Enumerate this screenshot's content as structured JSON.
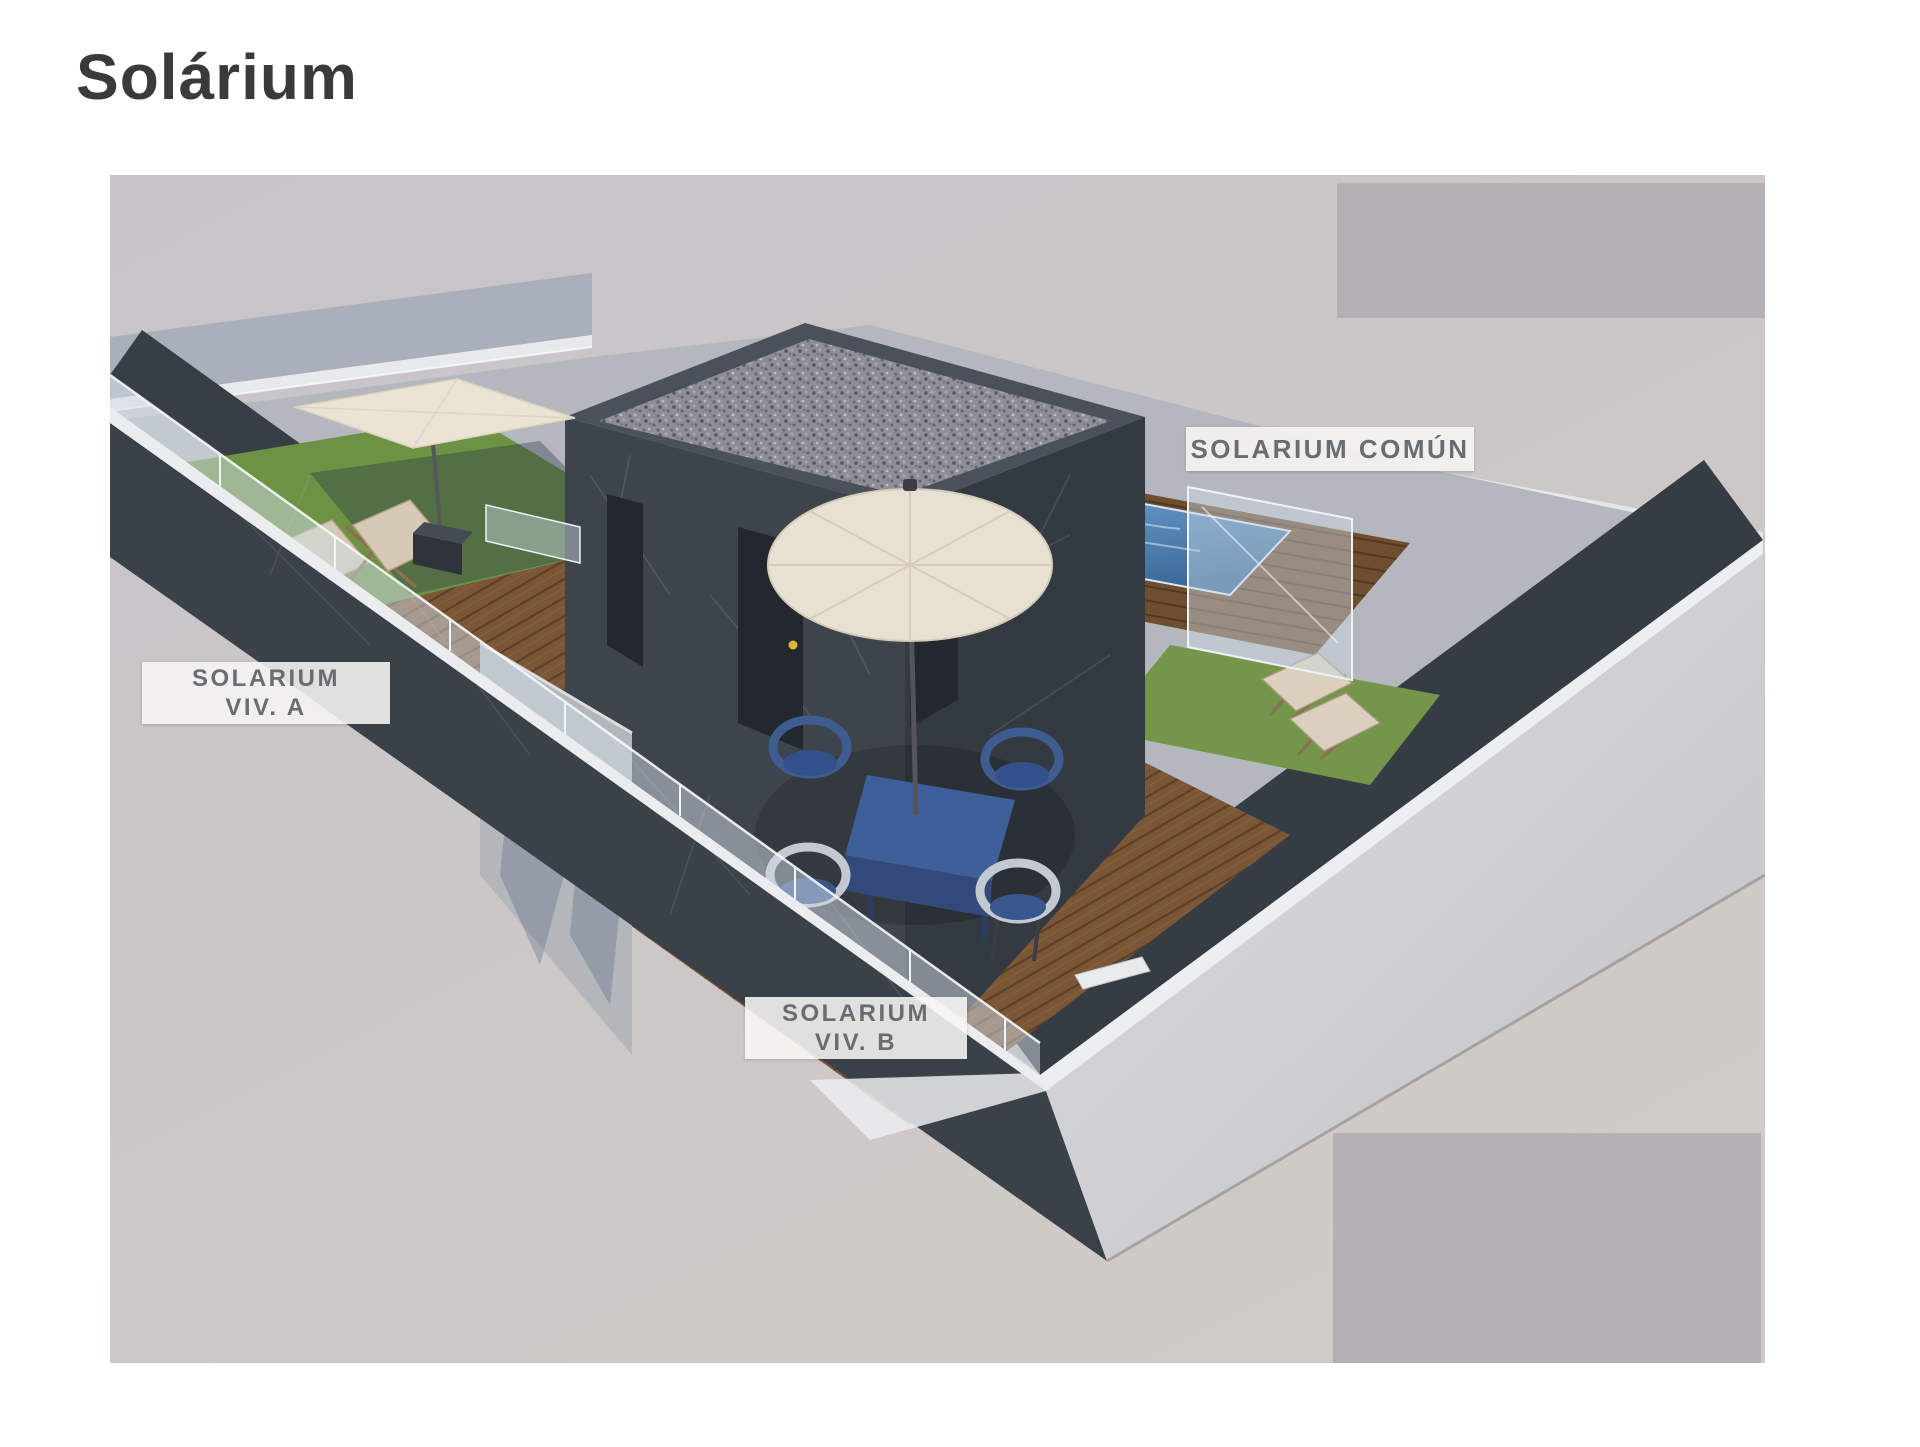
{
  "page": {
    "title": "Solárium",
    "background_color": "#ffffff",
    "title_color": "#3a3a3c"
  },
  "rendering": {
    "type": "3d-architectural-visualization",
    "subject": "rooftop solarium terrace with private and common areas",
    "background_color": "#c9c5c9",
    "labels": {
      "comun": {
        "text": "SOLARIUM COMÚN"
      },
      "viv_a": {
        "line1": "SOLARIUM",
        "line2": "VIV. A"
      },
      "viv_b": {
        "line1": "SOLARIUM",
        "line2": "VIV. B"
      }
    },
    "label_style": {
      "background": "rgba(247,246,244,0.88)",
      "text_color": "#696d73"
    },
    "scene_elements": [
      "central-stair-core-building",
      "gravel-roof",
      "plunge-pool",
      "wood-decking",
      "wood-steps",
      "artificial-grass",
      "glass-railing",
      "square-parasol",
      "round-umbrella",
      "dining-table-set",
      "deck-chairs",
      "sun-loungers",
      "flower-planter-wall",
      "perimeter-parapet-walls"
    ],
    "colors": {
      "charcoal_wall": "#3d434b",
      "wood_deck": "#7c5737",
      "grass": "#6e9244",
      "pool_water": "#4a7fb5",
      "canvas_cream": "#e9e2d2",
      "light_wall": "#a9b0bc",
      "wall_cap_white": "#eceded"
    }
  },
  "overlays": {
    "color": "#b4b0b5",
    "count": 2
  }
}
